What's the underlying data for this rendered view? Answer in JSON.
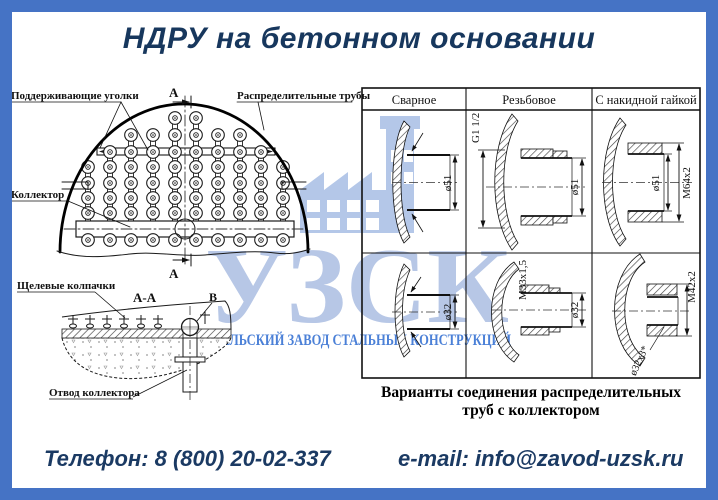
{
  "page": {
    "title": "НДРУ на бетонном основании",
    "frame_color": "#4573c5",
    "title_color": "#17375d"
  },
  "watermark": {
    "logo_text": "УЗСК",
    "subtitle": "УРАЛЬСКИЙ ЗАВОД СТАЛЬНЫХ КОНСТРУКЦИЙ",
    "icon": "factory-icon",
    "logo_color": "#b7c7e6",
    "subtitle_color": "#4b80d7"
  },
  "plan_view": {
    "labels": {
      "supporting_angles": "Поддерживающие уголки",
      "distribution_pipes": "Распределительные трубы",
      "collector": "Коллектор",
      "section_mark_top": "А",
      "section_mark_bottom": "А"
    }
  },
  "section_view": {
    "title": "А-А",
    "detail_mark": "В",
    "labels": {
      "slot_caps": "Щелевые колпачки",
      "collector_outlet": "Отвод коллектора"
    }
  },
  "connections_table": {
    "columns": [
      "Сварное",
      "Резьбовое",
      "С накидной гайкой"
    ],
    "rows": [
      {
        "cells": [
          {
            "dims": [
              "ø51"
            ]
          },
          {
            "dims": [
              "G1 1/2",
              "ø51"
            ]
          },
          {
            "dims": [
              "ø51",
              "M64x2"
            ]
          }
        ]
      },
      {
        "cells": [
          {
            "dims": [
              "ø32"
            ]
          },
          {
            "dims": [
              "M33x1,5",
              "ø32"
            ]
          },
          {
            "dims": [
              "M42x2",
              "ø32x3*"
            ]
          }
        ]
      }
    ],
    "caption_line1": "Варианты соединения распределительных",
    "caption_line2": "труб с коллектором"
  },
  "contacts": {
    "phone": "Телефон: 8 (800) 20-02-337",
    "email": "e-mail: info@zavod-uzsk.ru"
  }
}
